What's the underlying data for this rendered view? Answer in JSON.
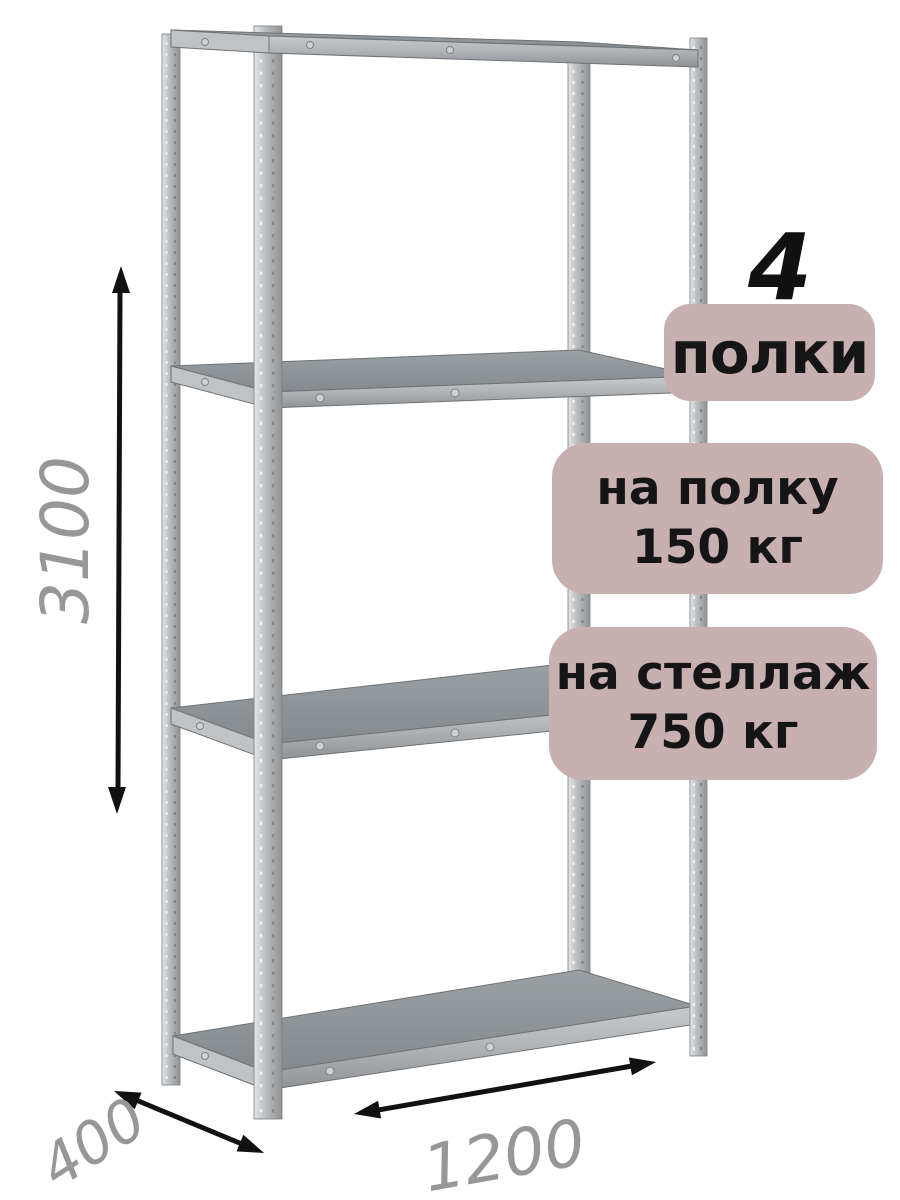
{
  "badges": {
    "count": "4",
    "count_label": "полки",
    "shelf_load_line1": "на полку",
    "shelf_load_line2": "150 кг",
    "rack_load_line1": "на стеллаж",
    "rack_load_line2": "750 кг"
  },
  "dimensions": {
    "height": "3100",
    "depth": "400",
    "width": "1200"
  },
  "illustration": {
    "subject": "metal shelving rack with 4 shelves, 3D view",
    "shelf_count": 4
  },
  "colors": {
    "background": "#ffffff",
    "badge_bg": "#c8b0b0",
    "badge_text": "#151515",
    "dimension_text": "#979797",
    "arrow": "#111111",
    "metal_light": "#e3e5e6",
    "metal_mid": "#b7bbbe",
    "metal_dark": "#8f9396",
    "shelf_top": "#8d9195"
  }
}
